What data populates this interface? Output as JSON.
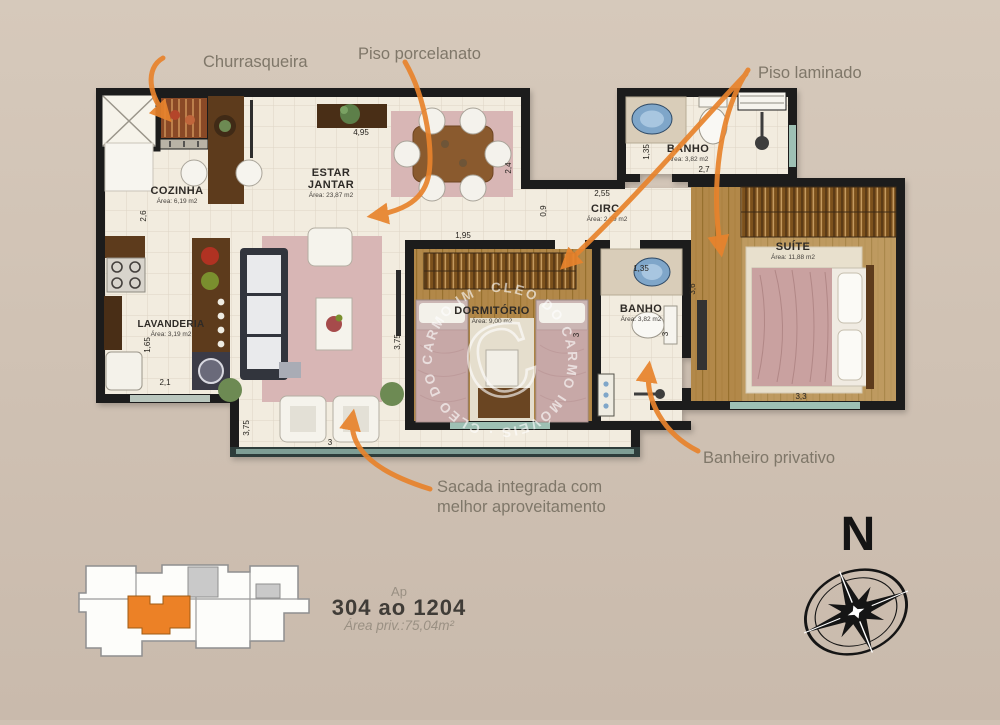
{
  "page": {
    "bg": "#cfc1b3"
  },
  "annotations": {
    "churrasqueira": "Churrasqueira",
    "piso_porcelanato": "Piso porcelanato",
    "piso_laminado": "Piso laminado",
    "sacada_line1": "Sacada integrada com",
    "sacada_line2": "melhor aproveitamento",
    "banheiro_privativo": "Banheiro privativo"
  },
  "rooms": {
    "cozinha": {
      "name": "COZINHA",
      "area": "Área: 6,19 m2"
    },
    "estar": {
      "line1": "ESTAR",
      "line2": "JANTAR",
      "area": "Área: 23,87 m2"
    },
    "lavanderia": {
      "name": "LAVANDERIA",
      "area": "Área: 3,19 m2"
    },
    "banho_social": {
      "name": "BANHO",
      "area": "Área: 3,82 m2"
    },
    "circ": {
      "name": "CIRC.",
      "area": "Área: 2,29 m2"
    },
    "dormitorio": {
      "name": "DORMITÓRIO",
      "area": "Área: 9,00 m2"
    },
    "banho_suite": {
      "name": "BANHO",
      "area": "Área: 3,82 m2"
    },
    "suite": {
      "name": "SUÍTE",
      "area": "Área: 11,88 m2"
    }
  },
  "dimensions": {
    "cozinha_h": "4,95",
    "cozinha_v": "2,6",
    "lavanderia_v": "1,65",
    "lavanderia_h": "2,1",
    "sacada_v": "3,75",
    "sacada_h": "3",
    "estar_v": "3,75",
    "jantar_v": "2,4",
    "passagem_h": "1,95",
    "circ_v": "0,9",
    "circ_h": "2,55",
    "banho_social_v": "1,35",
    "banho_social_h": "2,7",
    "banho_suite_h": "1,35",
    "banho_suite_v": "3",
    "dormitorio_v": "3",
    "suite_v": "3,6",
    "suite_h": "3,3"
  },
  "footer": {
    "ap": "Ap",
    "units": "304 ao 1204",
    "private_area": "Área priv.:75,04m²"
  },
  "compass": {
    "north": "N"
  },
  "watermark": {
    "ring_text": "· CLEO DO CARMO IMÓVEIS · CLEO DO CARMO IMÓVEIS ",
    "monogram": "C"
  },
  "colors": {
    "accent_orange": "#E8832C",
    "wall_black": "#1B1B1B",
    "floor_cream": "#F2ECDF",
    "wood": "#B2884A",
    "rug_pink": "#D8B6B5",
    "keyplan_orange": "#EC8126"
  }
}
